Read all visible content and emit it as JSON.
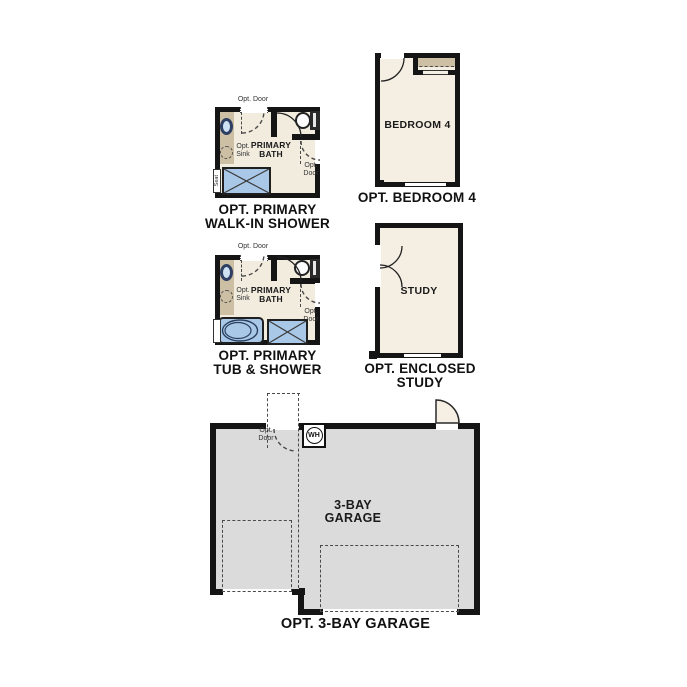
{
  "plans": {
    "walk_in_shower": {
      "caption_l1": "OPT. PRIMARY",
      "caption_l2": "WALK-IN SHOWER",
      "room_l1": "PRIMARY",
      "room_l2": "BATH",
      "opt_door_top": "Opt. Door",
      "opt_sink_l1": "Opt.",
      "opt_sink_l2": "Sink",
      "opt_door_side_l1": "Opt.",
      "opt_door_side_l2": "Door",
      "seat": "Seat"
    },
    "bedroom4": {
      "caption": "OPT. BEDROOM 4",
      "room": "BEDROOM 4"
    },
    "tub_shower": {
      "caption_l1": "OPT. PRIMARY",
      "caption_l2": "TUB & SHOWER",
      "room_l1": "PRIMARY",
      "room_l2": "BATH",
      "opt_door_top": "Opt. Door",
      "opt_sink_l1": "Opt.",
      "opt_sink_l2": "Sink",
      "opt_door_side_l1": "Opt.",
      "opt_door_side_l2": "Door"
    },
    "study": {
      "caption_l1": "OPT. ENCLOSED",
      "caption_l2": "STUDY",
      "room": "STUDY"
    },
    "garage": {
      "caption": "OPT. 3-BAY GARAGE",
      "room_l1": "3-BAY",
      "room_l2": "GARAGE",
      "opt_door_l1": "Opt.",
      "opt_door_l2": "Door",
      "water_heater": "WH"
    }
  },
  "colors": {
    "wall": "#151515",
    "bath_floor": "#f2ecdf",
    "room_floor": "#f5efe3",
    "garage_floor": "#dbdbdb",
    "vanity_tan": "#cdbfa3",
    "fixture_blue": "#a9c8e7",
    "sink_rim_navy": "#2e3f63",
    "door_leaf_cream": "#f6efe3"
  }
}
